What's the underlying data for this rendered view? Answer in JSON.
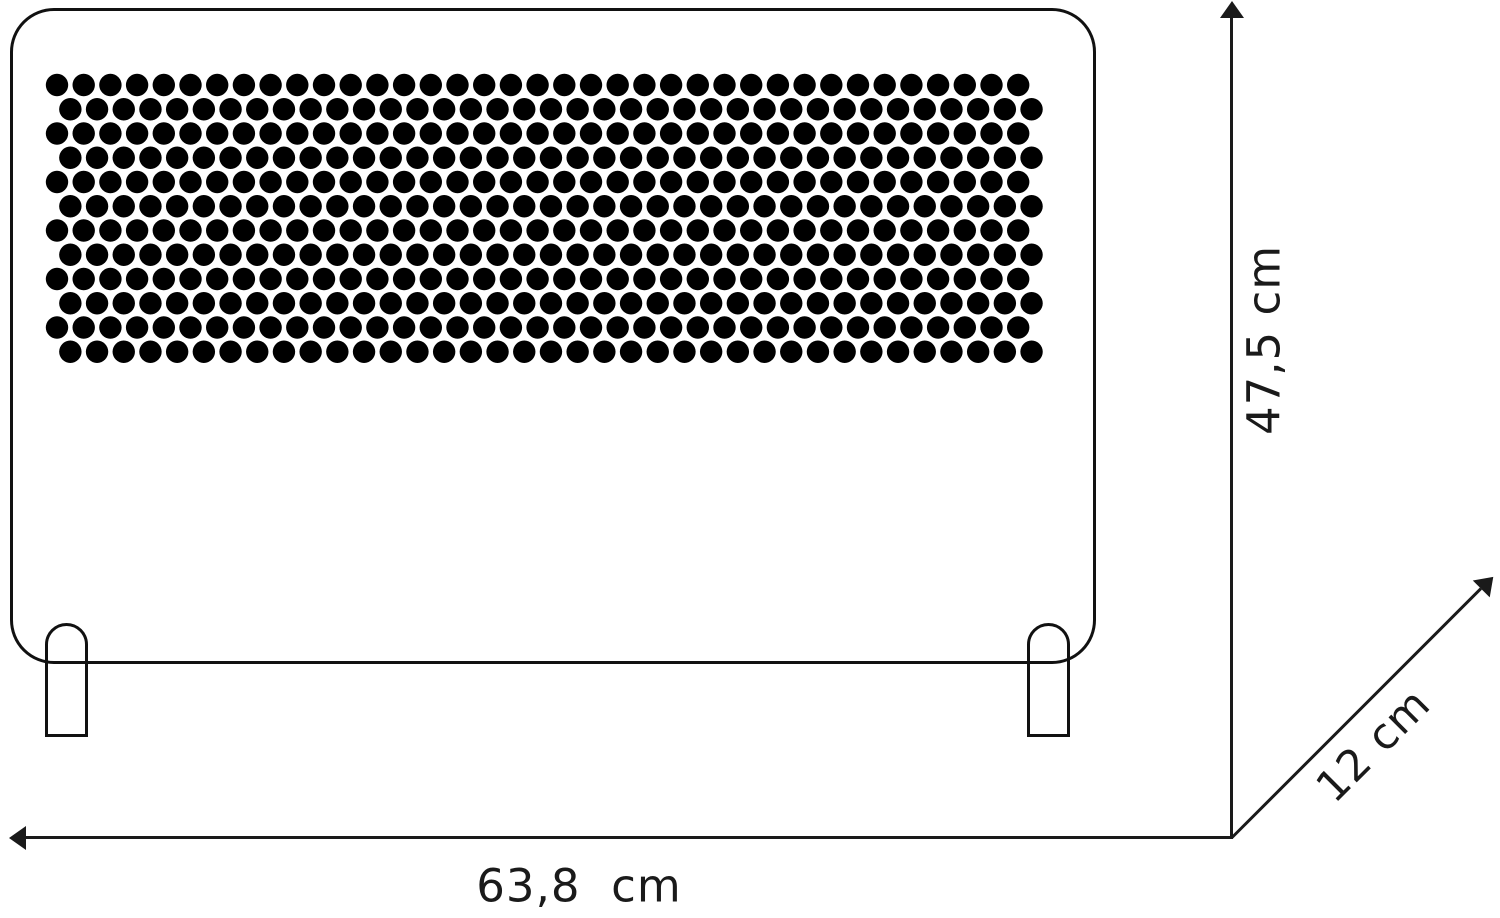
{
  "diagram": {
    "type": "product-dimension-drawing",
    "subject": "panel-convector-heater-front-view",
    "background_color": "#ffffff",
    "line_color": "#1a1a1a",
    "labels": {
      "width": "63,8  cm",
      "height": "47,5 cm",
      "depth": "12 cm"
    },
    "heater": {
      "perforation": {
        "rows": 12,
        "cols": 37,
        "origin_x": 57,
        "origin_y": 85,
        "pitch_x": 26.7,
        "pitch_y": 24.25,
        "stagger": 13.35,
        "dot_radius": 11.2,
        "dot_color": "#000000"
      }
    }
  }
}
